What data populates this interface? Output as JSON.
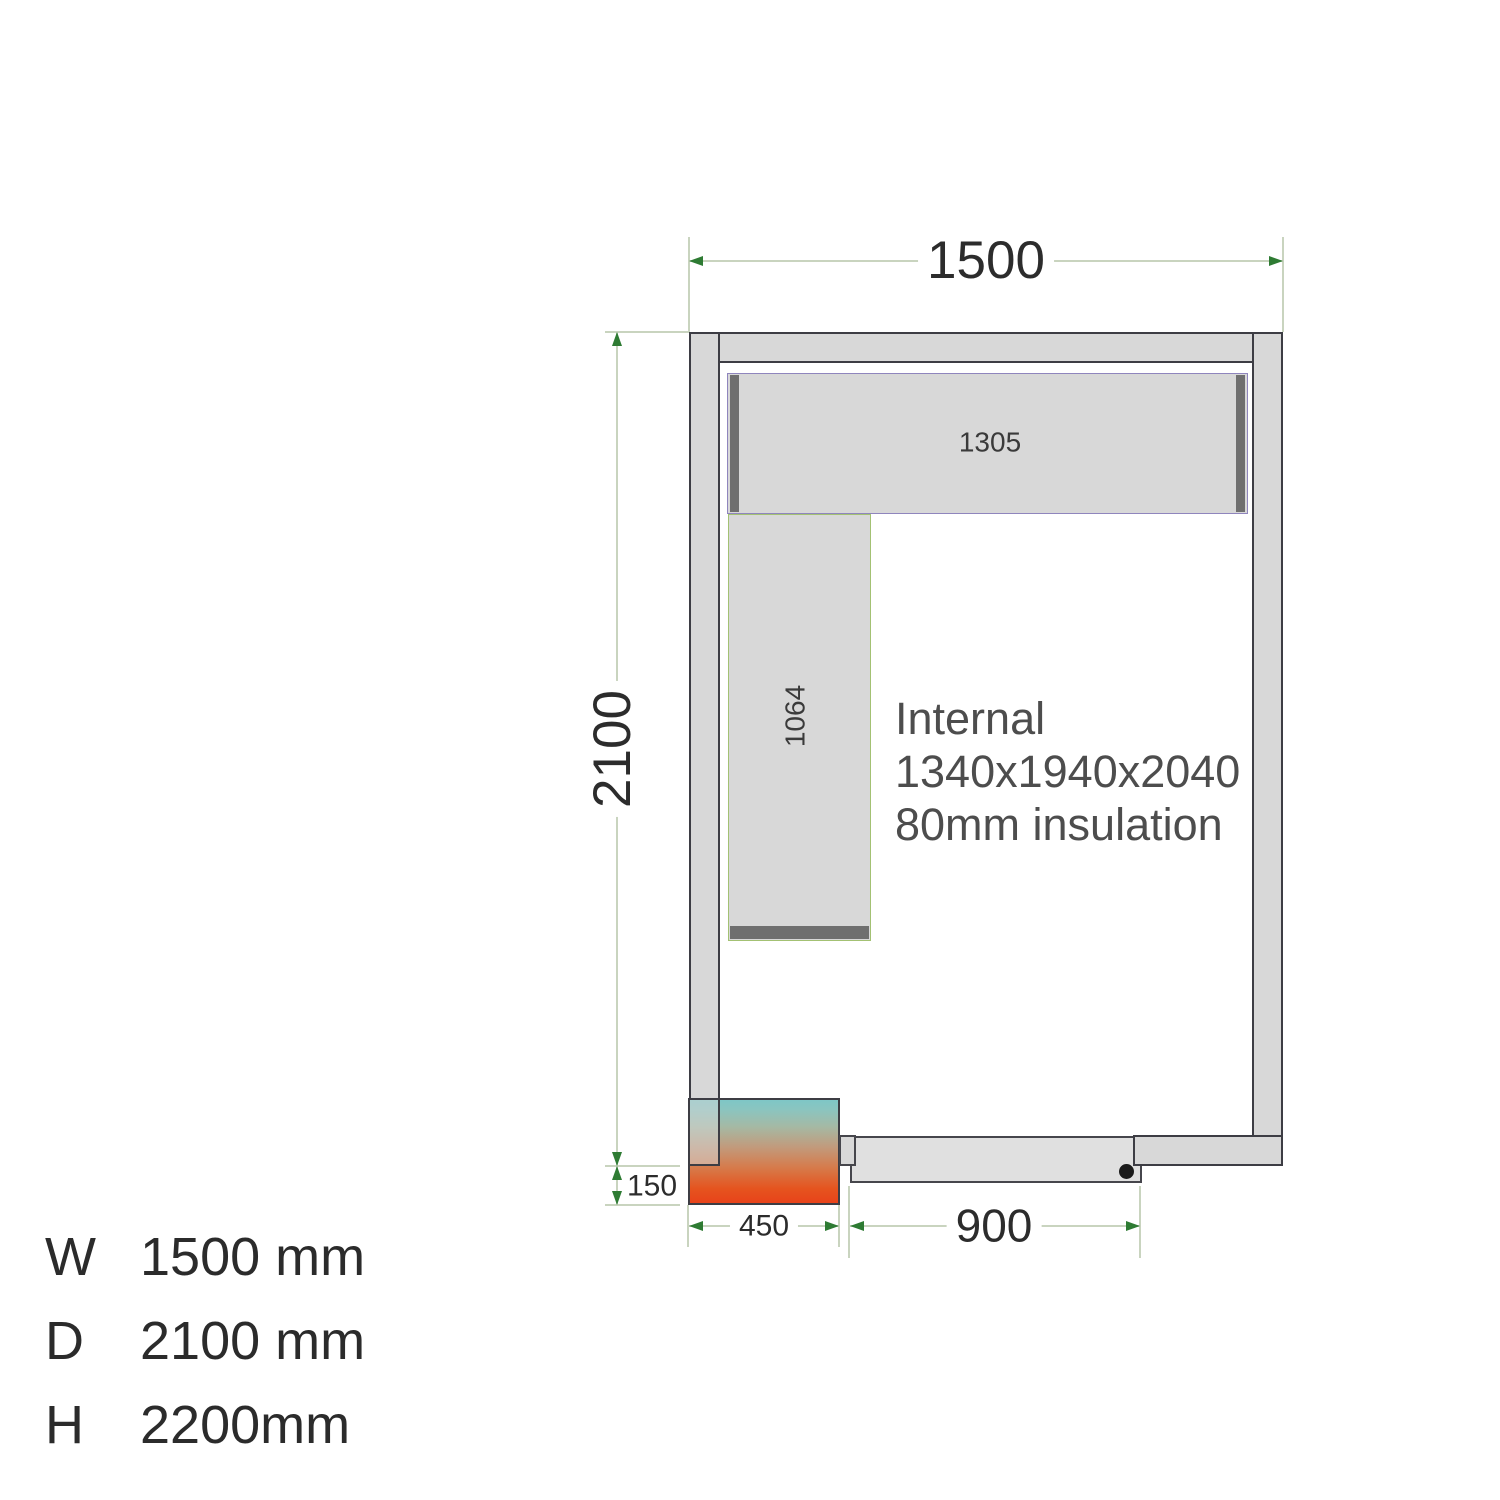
{
  "dimensions": {
    "width": "1500",
    "depth": "2100",
    "plinth_offset": "150",
    "unit_width": "450",
    "door_width": "900"
  },
  "shelves": {
    "top_shelf_label": "1305",
    "side_shelf_label": "1064"
  },
  "note": {
    "line1": "Internal",
    "line2": "1340x1940x2040",
    "line3": "80mm insulation"
  },
  "legend": {
    "rows": [
      {
        "key": "W",
        "value": "1500 mm"
      },
      {
        "key": "D",
        "value": "2100 mm"
      },
      {
        "key": "H",
        "value": "2200mm"
      }
    ]
  },
  "colors": {
    "wall_fill": "#d8d8d8",
    "wall_outline": "#3d3d44",
    "dimension_line": "#c9d4bf",
    "arrow_green": "#2e7b33",
    "shelf_edge_purple": "#8f85bd",
    "shelf_edge_green": "#a3c173",
    "shelf_end_bar": "#6f6f6f",
    "door_fill": "#e0e0e0",
    "door_dot": "#1b1b1b",
    "unit_gradient_top": "#7ec6c6",
    "unit_gradient_bottom": "#e8431a"
  }
}
